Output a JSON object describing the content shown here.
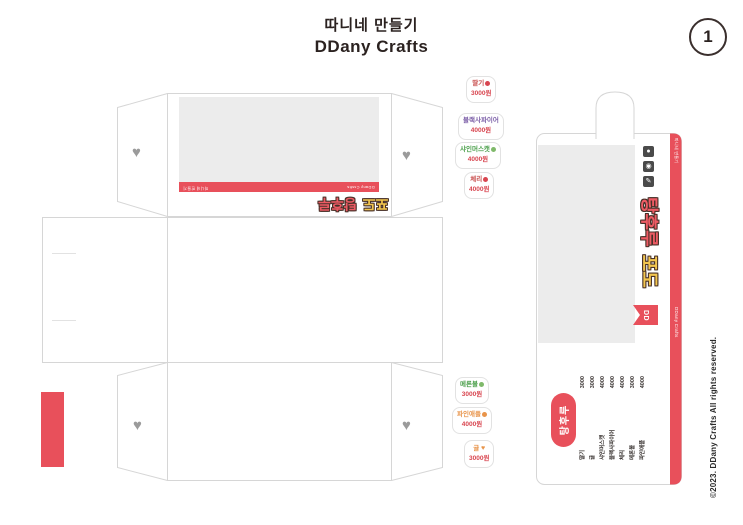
{
  "header": {
    "title_line1": "따니네 만들기",
    "title_line2": "DDany Crafts",
    "page_number": "1"
  },
  "footer": {
    "copyright": "©2023. DDany Crafts All rights reserved."
  },
  "colors": {
    "accent": "#e8505b",
    "bubble_yellow": "#f3c64f",
    "bubble_outline": "#473028",
    "heart_gray": "#9b9b9b",
    "window_gray": "#ececec",
    "dieline_gray": "#d6d6d6",
    "purple": "#7b5ea7",
    "green": "#4ca04c",
    "orange": "#e8944a",
    "ink": "#2b2220"
  },
  "box_net": {
    "front_label": {
      "word_yellow": "포도",
      "word_red": "탕후루"
    },
    "stripe": {
      "left_text": "따니네 만들기",
      "right_text": "DDany Crafts"
    },
    "heart_icon_glyph": "♥"
  },
  "side_panel": {
    "stripe_top_text": "따니네 만들기",
    "stripe_bottom_text": "DDany Crafts",
    "label_red": "탕후루",
    "label_yellow": "포도",
    "ribbon_text": "DD",
    "icons": [
      {
        "name": "speech-bubble-icon",
        "glyph": "●"
      },
      {
        "name": "camera-icon",
        "glyph": "◉"
      },
      {
        "name": "pencil-icon",
        "glyph": "✎"
      }
    ],
    "menu": {
      "title": "탕후루",
      "currency": "원",
      "items": [
        {
          "name": "딸기",
          "price": "3000"
        },
        {
          "name": "귤",
          "price": "3000"
        },
        {
          "name": "샤인머스캣",
          "price": "4000"
        },
        {
          "name": "블랙사파이어",
          "price": "4000"
        },
        {
          "name": "체리",
          "price": "4000"
        },
        {
          "name": "메론볼",
          "price": "3000"
        },
        {
          "name": "파인애플",
          "price": "4000"
        }
      ]
    }
  },
  "stickers": [
    {
      "name": "딸기",
      "price": "3000원",
      "color": "#c9504f",
      "icon": "strawberry-icon"
    },
    {
      "name": "블랙사파이어",
      "price": "4000원",
      "color": "#7b5ea7",
      "icon": "grape-icon"
    },
    {
      "name": "샤인머스캣",
      "price": "4000원",
      "color": "#4ca04c",
      "icon": "muscat-icon"
    },
    {
      "name": "체리",
      "price": "4000원",
      "color": "#c9504f",
      "icon": "cherry-icon"
    },
    {
      "name": "메론볼",
      "price": "3000원",
      "color": "#4ca04c",
      "icon": "melon-icon"
    },
    {
      "name": "파인애플",
      "price": "4000원",
      "color": "#e8944a",
      "icon": "pineapple-icon"
    },
    {
      "name": "귤",
      "price": "3000원",
      "color": "#e8944a",
      "icon": "tangerine-heart-icon",
      "glyph": "♥"
    }
  ]
}
